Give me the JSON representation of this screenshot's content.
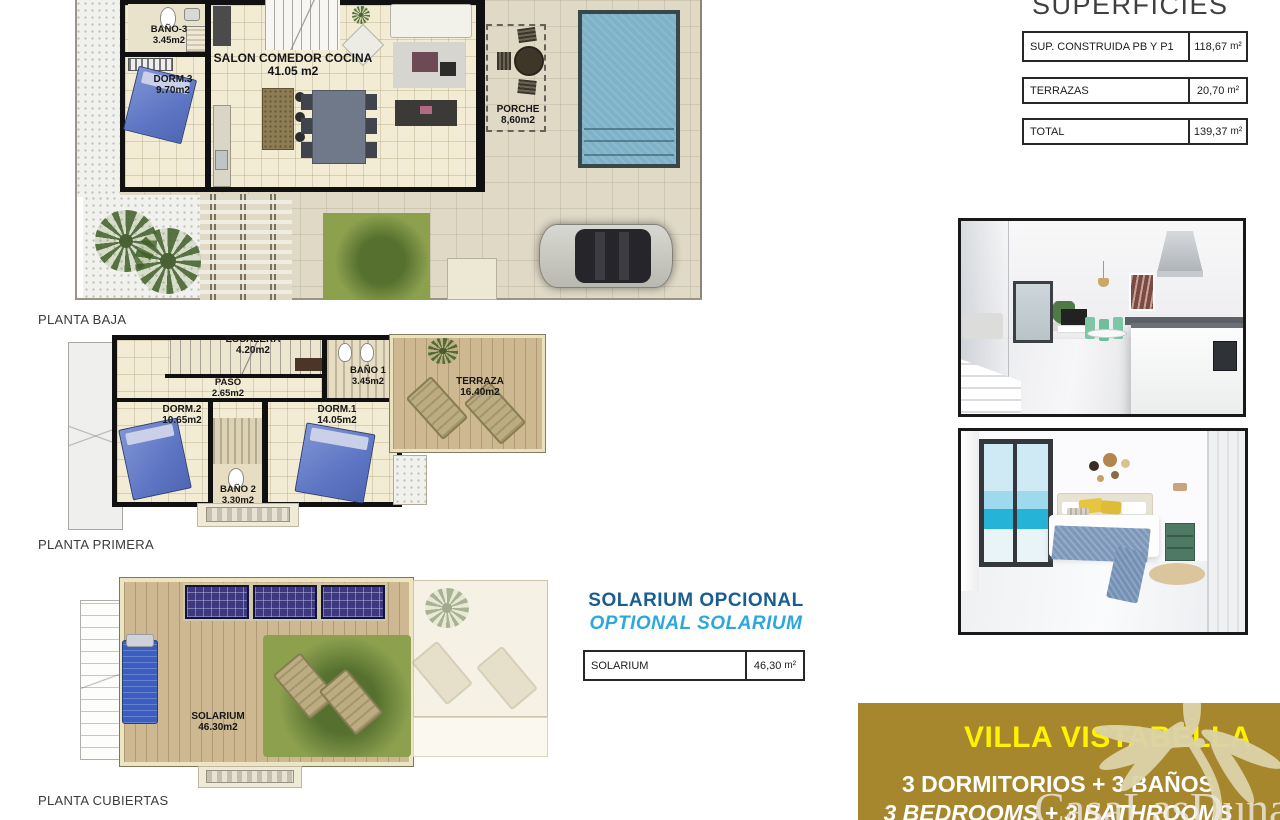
{
  "captions": {
    "baja": "PLANTA BAJA",
    "primera": "PLANTA PRIMERA",
    "cubiertas": "PLANTA CUBIERTAS"
  },
  "rooms": {
    "bano3": {
      "n": "BAÑO-3",
      "a": "3.45m2"
    },
    "dorm3": {
      "n": "DORM.3",
      "a": "9.70m2"
    },
    "salon": {
      "n": "SALON COMEDOR COCINA",
      "a": "41.05 m2"
    },
    "porche": {
      "n": "PORCHE",
      "a": "8,60m2"
    },
    "escalera": {
      "n": "ESCALERA",
      "a": "4.20m2"
    },
    "paso": {
      "n": "PASO",
      "a": "2.65m2"
    },
    "bano1": {
      "n": "BAÑO 1",
      "a": "3.45m2"
    },
    "dorm2": {
      "n": "DORM.2",
      "a": "10.65m2"
    },
    "dorm1": {
      "n": "DORM.1",
      "a": "14.05m2"
    },
    "bano2": {
      "n": "BAÑO 2",
      "a": "3.30m2"
    },
    "terraza": {
      "n": "TERRAZA",
      "a": "16.40m2"
    },
    "solarium": {
      "n": "SOLARIUM",
      "a": "46.30m2"
    }
  },
  "superficies": {
    "title": "SUPERFICIES",
    "rows": [
      {
        "label": "SUP. CONSTRUIDA PB Y P1",
        "value": "118,67",
        "unit": "m²"
      },
      {
        "label": "TERRAZAS",
        "value": "20,70",
        "unit": "m²"
      },
      {
        "label": "TOTAL",
        "value": "139,37",
        "unit": "m²"
      }
    ]
  },
  "solarium_option": {
    "title_es": "SOLARIUM OPCIONAL",
    "title_en": "OPTIONAL SOLARIUM",
    "table_label": "SOLARIUM",
    "table_value": "46,30",
    "table_unit": "m²"
  },
  "banner": {
    "title": "VILLA VISTABELLA",
    "line_es": "3 DORMITORIOS + 3 BAÑOS",
    "line_en": "3 BEDROOMS + 3 BATHROOMS",
    "bg_color": "#A6872D",
    "title_color": "#FFF200"
  },
  "watermark": "CasaLasDunas",
  "accent_colors": {
    "solarium_es": "#1A5E90",
    "solarium_en": "#2CA8DE",
    "pool": "#7EB2C8"
  }
}
